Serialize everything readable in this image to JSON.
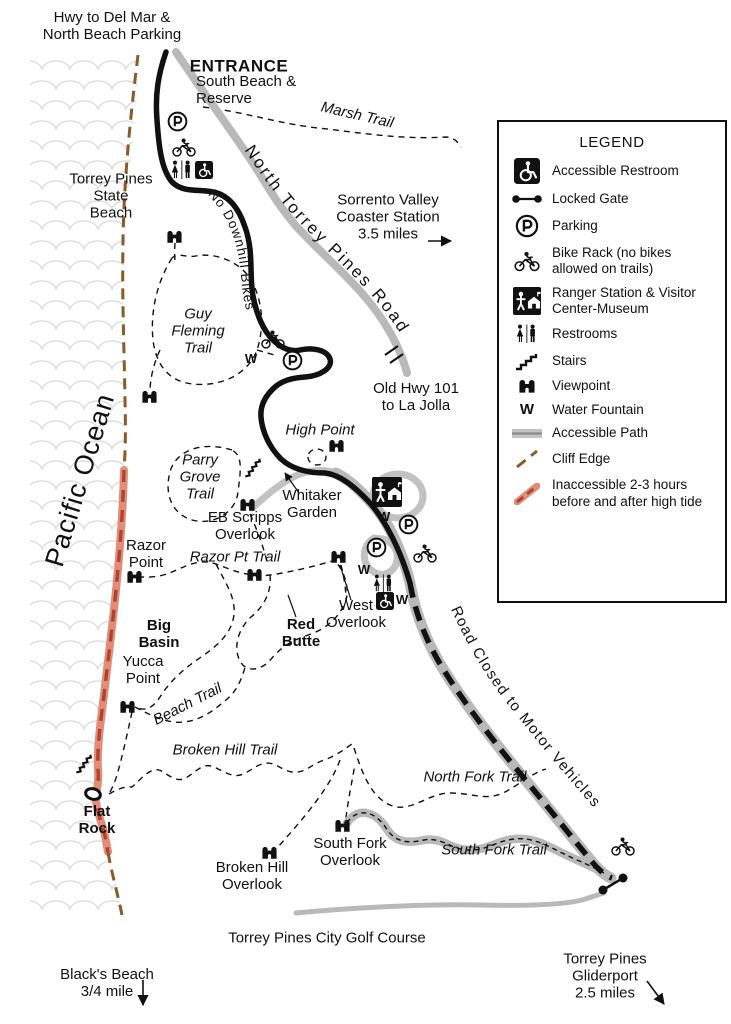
{
  "labels": {
    "hwy_del_mar": "Hwy to Del Mar &\nNorth Beach Parking",
    "entrance": "ENTRANCE",
    "south_beach": "South Beach &\nReserve",
    "marsh_trail": "Marsh Trail",
    "torrey_pines_state_beach": "Torrey Pines\nState\nBeach",
    "sorrento": "Sorrento Valley\nCoaster Station\n3.5 miles",
    "north_torrey_pines_road": "North Torrey Pines Road",
    "no_downhill_bikes": "No Downhill Bikes",
    "guy_fleming_trail": "Guy\nFleming\nTrail",
    "old_hwy": "Old Hwy 101\nto La Jolla",
    "high_point": "High Point",
    "parry_grove_trail": "Parry\nGrove\nTrail",
    "whitaker_garden": "Whitaker\nGarden",
    "eb_scripps_overlook": "EB Scripps\nOverlook",
    "razor_point": "Razor\nPoint",
    "razor_pt_trail": "Razor Pt Trail",
    "west_overlook": "West\nOverlook",
    "big_basin": "Big\nBasin",
    "red_butte": "Red\nButte",
    "yucca_point": "Yucca\nPoint",
    "beach_trail": "Beach Trail",
    "broken_hill_trail": "Broken Hill Trail",
    "north_fork_trail": "North Fork Trail",
    "south_fork_trail": "South Fork Trail",
    "south_fork_overlook": "South Fork\nOverlook",
    "broken_hill_overlook": "Broken Hill\nOverlook",
    "flat_rock": "Flat\nRock",
    "road_closed": "Road Closed to Motor Vehicles",
    "golf_course": "Torrey Pines City Golf Course",
    "blacks_beach": "Black's Beach\n3/4 mile",
    "gliderport": "Torrey Pines Gliderport\n2.5 miles",
    "pacific_ocean": "Pacific Ocean"
  },
  "legend": {
    "title": "LEGEND",
    "items": [
      {
        "icon": "accessible-restroom-icon",
        "label": "Accessible Restroom"
      },
      {
        "icon": "locked-gate-icon",
        "label": "Locked Gate"
      },
      {
        "icon": "parking-icon",
        "label": "Parking"
      },
      {
        "icon": "bike-rack-icon",
        "label": "Bike Rack (no bikes allowed on trails)"
      },
      {
        "icon": "ranger-station-icon",
        "label": "Ranger Station & Visitor Center-Museum"
      },
      {
        "icon": "restrooms-icon",
        "label": "Restrooms"
      },
      {
        "icon": "stairs-icon",
        "label": "Stairs"
      },
      {
        "icon": "viewpoint-icon",
        "label": "Viewpoint"
      },
      {
        "icon": "water-fountain-icon",
        "label": "Water Fountain"
      },
      {
        "icon": "accessible-path-icon",
        "label": "Accessible Path"
      },
      {
        "icon": "cliff-edge-icon",
        "label": "Cliff Edge"
      },
      {
        "icon": "tide-icon",
        "label": "Inaccessible 2-3 hours before and after high tide"
      }
    ]
  },
  "icons": {
    "water_label": "W"
  },
  "colors": {
    "ink": "#111111",
    "road_gray": "#b9b9b9",
    "path_gray": "#c2c2c2",
    "cliff_brown": "#8a5a28",
    "tide_salmon": "#e28d7a",
    "tide_red": "#ad4430",
    "wave_gray": "#dedede"
  }
}
